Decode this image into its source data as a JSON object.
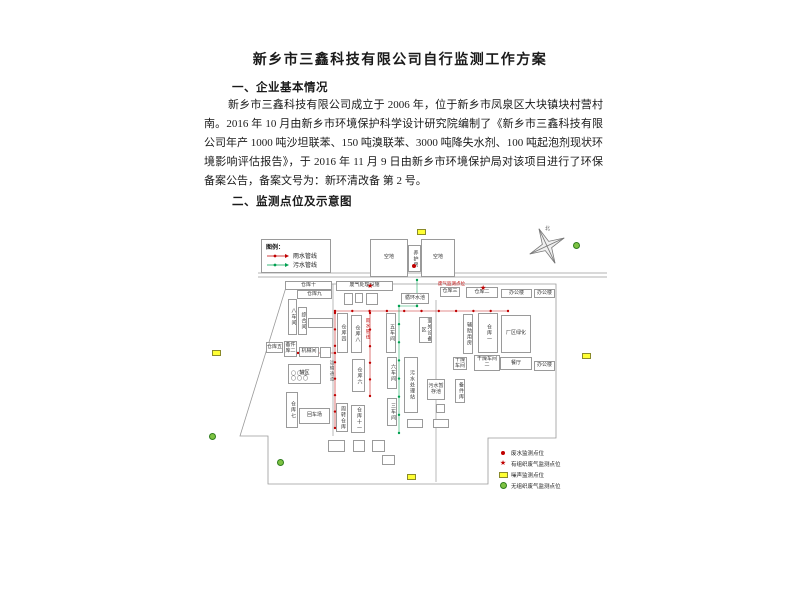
{
  "document": {
    "title": "新乡市三鑫科技有限公司自行监测工作方案",
    "section1_heading": "一、企业基本情况",
    "section1_paragraph": "新乡市三鑫科技有限公司成立于 2006 年，位于新乡市凤泉区大块镇块村营村南。2016 年 10 月由新乡市环境保护科学设计研究院编制了《新乡市三鑫科技有限公司年产 1000 吨沙坦联苯、150 吨溴联苯、3000 吨降失水剂、100 吨起泡剂现状环境影响评估报告》，于 2016 年 11 月 9 日由新乡市环境保护局对该项目进行了环保备案公告，备案文号为：新环清改备 第 2 号。",
    "section2_heading": "二、监测点位及示意图"
  },
  "diagram": {
    "compass_label": "北",
    "colors": {
      "rain": "#c00000",
      "sewage": "#00a050",
      "outline": "#9a9a9a"
    },
    "pipe_legend": {
      "title": "图例：",
      "items": [
        {
          "label": "雨水管线",
          "color": "#c00000"
        },
        {
          "label": "污水管线",
          "color": "#00a050"
        }
      ]
    },
    "point_legend": [
      {
        "marker": "dot",
        "color": "#c00000",
        "label": "废水监测点位"
      },
      {
        "marker": "star",
        "color": "#c00000",
        "label": "有组织废气监测点位"
      },
      {
        "marker": "rect",
        "color": "#ffff33",
        "label": "噪声监测点位"
      },
      {
        "marker": "circle",
        "color": "#7dc242",
        "label": "无组织废气监测点位"
      }
    ],
    "buildings": [
      {
        "label": "空地",
        "x": 170,
        "y": 21,
        "w": 38,
        "h": 38
      },
      {
        "label": "养护房",
        "x": 208,
        "y": 27,
        "w": 13,
        "h": 27,
        "v": true
      },
      {
        "label": "空地",
        "x": 221,
        "y": 21,
        "w": 34,
        "h": 38
      },
      {
        "label": "仓库十",
        "x": 85,
        "y": 63,
        "w": 47,
        "h": 9
      },
      {
        "label": "仓库九",
        "x": 97,
        "y": 72,
        "w": 35,
        "h": 9
      },
      {
        "label": "八车间",
        "x": 88,
        "y": 81,
        "w": 9,
        "h": 36,
        "v": true
      },
      {
        "label": "综合间",
        "x": 98,
        "y": 89,
        "w": 9,
        "h": 28,
        "v": true
      },
      {
        "label": "",
        "x": 108,
        "y": 100,
        "w": 25,
        "h": 10
      },
      {
        "label": "仓库五",
        "x": 66,
        "y": 124,
        "w": 17,
        "h": 11
      },
      {
        "label": "备件库二",
        "x": 84,
        "y": 123,
        "w": 13,
        "h": 16
      },
      {
        "label": "机械间",
        "x": 99,
        "y": 129,
        "w": 20,
        "h": 10
      },
      {
        "label": "",
        "x": 120,
        "y": 129,
        "w": 11,
        "h": 11
      },
      {
        "label": "罐区",
        "x": 88,
        "y": 146,
        "w": 33,
        "h": 20,
        "tanks": true
      },
      {
        "label": "仓库七",
        "x": 86,
        "y": 174,
        "w": 12,
        "h": 36,
        "v": true
      },
      {
        "label": "回车场",
        "x": 99,
        "y": 190,
        "w": 31,
        "h": 16
      },
      {
        "label": "周转仓库",
        "x": 136,
        "y": 185,
        "w": 12,
        "h": 29,
        "v": true
      },
      {
        "label": "仓库十一",
        "x": 151,
        "y": 187,
        "w": 14,
        "h": 28,
        "v": true
      },
      {
        "label": "",
        "x": 128,
        "y": 222,
        "w": 17,
        "h": 12
      },
      {
        "label": "",
        "x": 153,
        "y": 222,
        "w": 12,
        "h": 12
      },
      {
        "label": "",
        "x": 172,
        "y": 222,
        "w": 13,
        "h": 12
      },
      {
        "label": "",
        "x": 182,
        "y": 237,
        "w": 13,
        "h": 10
      },
      {
        "label": "废气处理设施",
        "x": 136,
        "y": 63,
        "w": 57,
        "h": 10
      },
      {
        "label": "",
        "x": 144,
        "y": 75,
        "w": 9,
        "h": 12
      },
      {
        "label": "",
        "x": 155,
        "y": 75,
        "w": 8,
        "h": 10
      },
      {
        "label": "",
        "x": 166,
        "y": 75,
        "w": 12,
        "h": 12
      },
      {
        "label": "循环水池",
        "x": 201,
        "y": 75,
        "w": 28,
        "h": 11
      },
      {
        "label": "仓库四",
        "x": 137,
        "y": 95,
        "w": 11,
        "h": 40,
        "v": true
      },
      {
        "label": "仓库八",
        "x": 151,
        "y": 97,
        "w": 11,
        "h": 38,
        "v": true
      },
      {
        "label": "五车间",
        "x": 186,
        "y": 95,
        "w": 10,
        "h": 40,
        "v": true
      },
      {
        "label": "仓库六",
        "x": 152,
        "y": 141,
        "w": 13,
        "h": 33,
        "v": true
      },
      {
        "label": "六车间",
        "x": 187,
        "y": 139,
        "w": 10,
        "h": 32,
        "v": true
      },
      {
        "label": "三车间",
        "x": 187,
        "y": 180,
        "w": 10,
        "h": 28,
        "v": true
      },
      {
        "label": "污水处理站",
        "x": 204,
        "y": 139,
        "w": 14,
        "h": 56,
        "v": true
      },
      {
        "label": "室外设备区",
        "x": 219,
        "y": 99,
        "w": 13,
        "h": 26,
        "v": true
      },
      {
        "label": "污水暂存池",
        "x": 227,
        "y": 161,
        "w": 18,
        "h": 21
      },
      {
        "label": "备件库",
        "x": 255,
        "y": 161,
        "w": 10,
        "h": 24,
        "v": true
      },
      {
        "label": "",
        "x": 207,
        "y": 201,
        "w": 16,
        "h": 9
      },
      {
        "label": "",
        "x": 233,
        "y": 201,
        "w": 16,
        "h": 9
      },
      {
        "label": "",
        "x": 236,
        "y": 186,
        "w": 9,
        "h": 9
      },
      {
        "label": "仓库三",
        "x": 240,
        "y": 69,
        "w": 20,
        "h": 10
      },
      {
        "label": "仓库二",
        "x": 266,
        "y": 69,
        "w": 32,
        "h": 11
      },
      {
        "label": "办公楼",
        "x": 301,
        "y": 71,
        "w": 31,
        "h": 9
      },
      {
        "label": "办公楼",
        "x": 334,
        "y": 71,
        "w": 21,
        "h": 9
      },
      {
        "label": "辅助用房",
        "x": 263,
        "y": 96,
        "w": 10,
        "h": 40,
        "v": true
      },
      {
        "label": "仓库一",
        "x": 278,
        "y": 95,
        "w": 20,
        "h": 40,
        "v": true
      },
      {
        "label": "厂区绿化",
        "x": 301,
        "y": 97,
        "w": 30,
        "h": 38
      },
      {
        "label": "干燥车间",
        "x": 253,
        "y": 139,
        "w": 14,
        "h": 13
      },
      {
        "label": "干燥车间二",
        "x": 274,
        "y": 137,
        "w": 26,
        "h": 16
      },
      {
        "label": "餐厅",
        "x": 300,
        "y": 139,
        "w": 32,
        "h": 13
      },
      {
        "label": "办公楼",
        "x": 334,
        "y": 143,
        "w": 21,
        "h": 10
      }
    ],
    "free_texts": [
      {
        "label": "运输通道",
        "x": 130,
        "y": 142,
        "v": true,
        "color": "#555555"
      },
      {
        "label": "雨水管线",
        "x": 166,
        "y": 100,
        "v": true,
        "color": "#c00000"
      },
      {
        "label": "废气监测点位",
        "x": 238,
        "y": 63,
        "color": "#c00000"
      }
    ],
    "outline_points": "87,66 356,66 356,220 288,220 288,266 68,266 68,218 40,218",
    "road_lines": [
      {
        "x1": 58,
        "y1": 55,
        "x2": 407,
        "y2": 55
      },
      {
        "x1": 58,
        "y1": 59,
        "x2": 407,
        "y2": 59
      },
      {
        "x1": 133,
        "y1": 66,
        "x2": 133,
        "y2": 218
      },
      {
        "x1": 236,
        "y1": 82,
        "x2": 236,
        "y2": 264
      }
    ],
    "pipelines": [
      {
        "color": "#c00000",
        "points": [
          [
            135,
            93
          ],
          [
            308,
            93
          ]
        ]
      },
      {
        "color": "#c00000",
        "points": [
          [
            170,
            95
          ],
          [
            170,
            178
          ]
        ]
      },
      {
        "color": "#c00000",
        "points": [
          [
            135,
            95
          ],
          [
            135,
            210
          ]
        ]
      },
      {
        "color": "#c00000",
        "points": [
          [
            98,
            135
          ],
          [
            135,
            135
          ]
        ]
      },
      {
        "color": "#00a050",
        "points": [
          [
            217,
            62
          ],
          [
            217,
            88
          ],
          [
            199,
            88
          ],
          [
            199,
            215
          ]
        ]
      }
    ],
    "point_markers": [
      {
        "type": "wastewater",
        "x": 214,
        "y": 48
      },
      {
        "type": "organized",
        "x": 170,
        "y": 68
      },
      {
        "type": "organized",
        "x": 283,
        "y": 70
      }
    ],
    "area_markers": [
      {
        "type": "noise",
        "x": 221,
        "y": 14
      },
      {
        "type": "noise",
        "x": 16,
        "y": 135
      },
      {
        "type": "noise",
        "x": 386,
        "y": 138
      },
      {
        "type": "noise",
        "x": 211,
        "y": 259
      },
      {
        "type": "fugitive",
        "x": 377,
        "y": 27
      },
      {
        "type": "fugitive",
        "x": 13,
        "y": 218
      },
      {
        "type": "fugitive",
        "x": 81,
        "y": 244
      }
    ]
  }
}
